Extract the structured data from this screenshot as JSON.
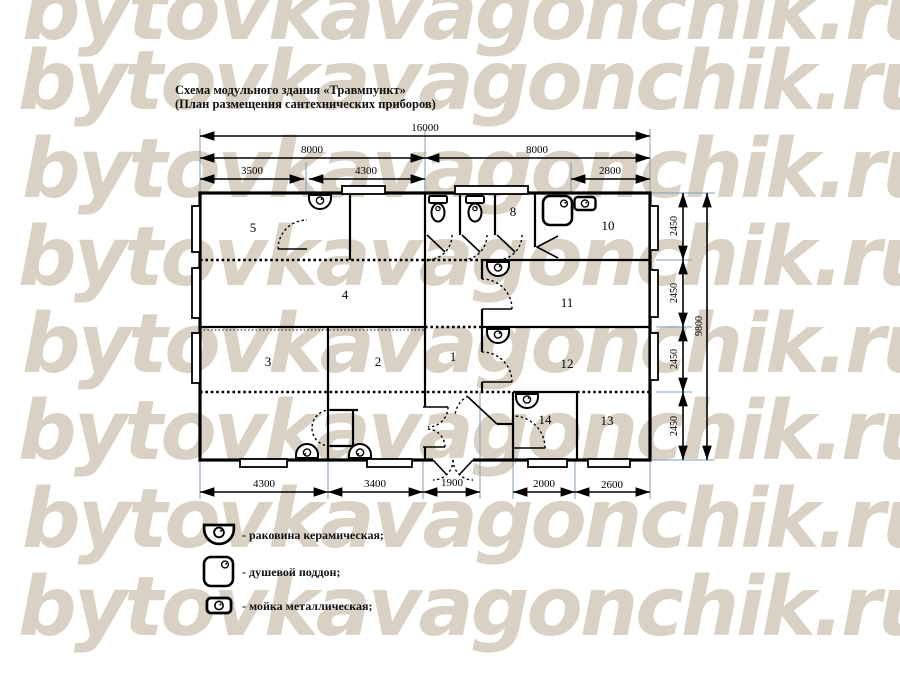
{
  "watermark": {
    "text": "bytovkavagonchik.ru",
    "color": "#d9d2c4"
  },
  "title": {
    "line1": "Схема модульного здания «Травмпункт»",
    "line2": "(План размещения сантехнических приборов)"
  },
  "dimensions": {
    "top_total": "16000",
    "top_left_half": "8000",
    "top_right_half": "8000",
    "top_seg1": "3500",
    "top_seg2": "4300",
    "top_seg3": "2800",
    "bottom_seg1": "4300",
    "bottom_seg2": "3400",
    "bottom_seg3": "1900",
    "bottom_seg4": "2000",
    "bottom_seg5": "2600",
    "right_module": "2450",
    "right_total": "9800"
  },
  "rooms": {
    "room1": "1",
    "room2": "2",
    "room3": "3",
    "room4": "4",
    "room5": "5",
    "room8": "8",
    "room10": "10",
    "room11": "11",
    "room12": "12",
    "room13": "13",
    "room14": "14"
  },
  "legend": {
    "items": [
      {
        "icon": "ceramic-sink-icon",
        "label": "- раковина керамическая;"
      },
      {
        "icon": "shower-tray-icon",
        "label": "- душевой поддон;"
      },
      {
        "icon": "metal-sink-icon",
        "label": "- мойка металлическая;"
      }
    ]
  },
  "colors": {
    "extension_line": "#7f9db9",
    "wall": "#000000"
  }
}
